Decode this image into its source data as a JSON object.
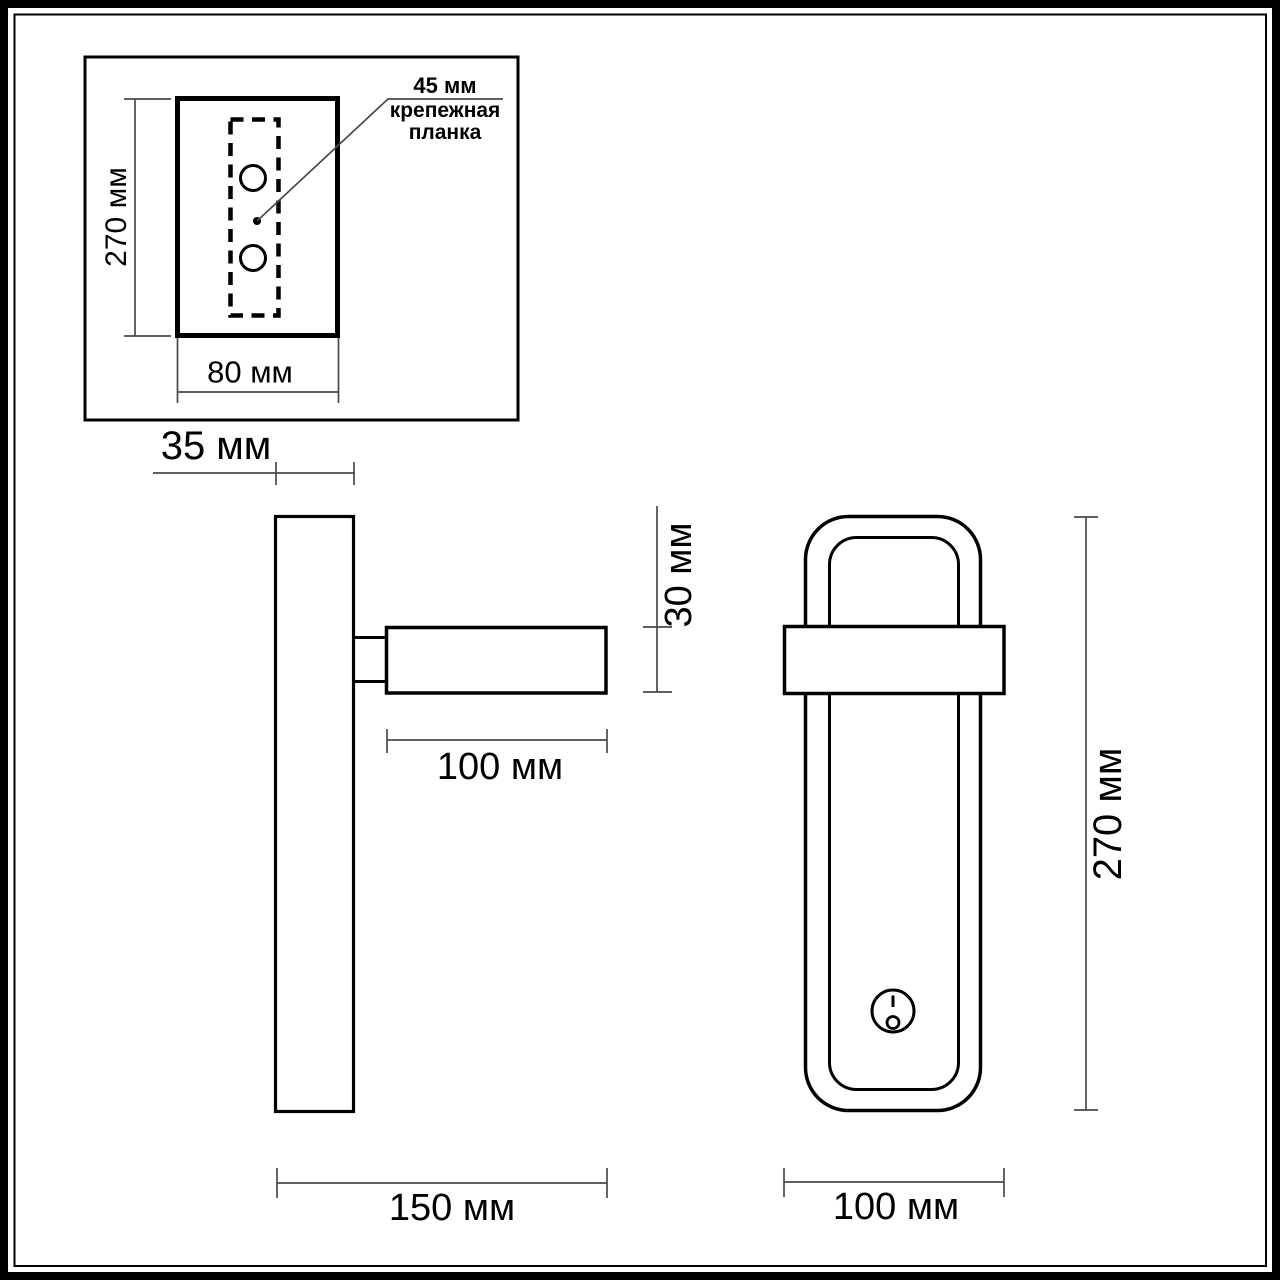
{
  "views": {
    "mounting_plate": {
      "callout_value": "45 мм",
      "callout_label_line1": "крепежная",
      "callout_label_line2": "планка",
      "height": "270 мм",
      "width": "80 мм"
    },
    "side": {
      "wall_offset": "35 мм",
      "head_height": "30 мм",
      "head_length": "100 мм",
      "total_depth": "150 мм"
    },
    "front": {
      "width": "100 мм",
      "height": "270 мм"
    }
  },
  "colors": {
    "outline": "#000000",
    "dimension_line": "#4a4a4a",
    "background": "#ffffff"
  }
}
